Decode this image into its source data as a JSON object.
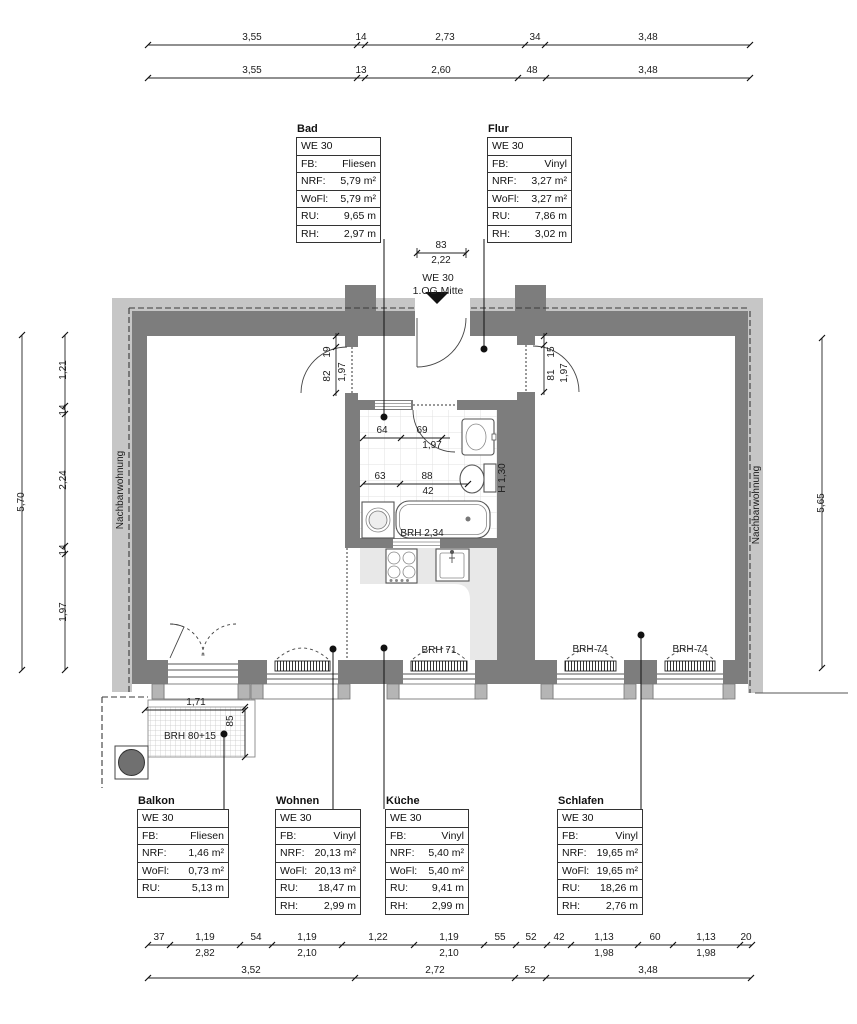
{
  "colors": {
    "wall_dark": "#7d7d7d",
    "wall_light": "#c6c6c6",
    "counter": "#e8e8e8"
  },
  "header_dims": {
    "row1": [
      "3,55",
      "14",
      "2,73",
      "34",
      "3,48"
    ],
    "row2": [
      "3,55",
      "13",
      "2,60",
      "48",
      "3,48"
    ]
  },
  "footer_dims": {
    "row1": [
      "37",
      "1,19",
      "54",
      "1,19",
      "1,22",
      "1,19",
      "55",
      "52",
      "42",
      "1,13",
      "60",
      "1,13",
      "20"
    ],
    "row1_sub": [
      "2,82",
      "2,10",
      "2,10",
      "1,98",
      "1,98"
    ],
    "row2": [
      "3,52",
      "2,72",
      "52",
      "3,48"
    ]
  },
  "side_dims": {
    "left_total": "5,70",
    "left_chain": [
      "1,21",
      "14",
      "2,24",
      "14",
      "1,97"
    ],
    "right_total": "5,65"
  },
  "entrance": {
    "label_line1": "WE 30",
    "label_line2": "1.OG Mitte",
    "width": "83",
    "width_total": "2,22"
  },
  "plan_labels": {
    "neighbor_left": "Nachbarwohnung",
    "neighbor_right": "Nachbarwohnung",
    "door_wohnen": [
      "19",
      "82",
      "1,97"
    ],
    "door_schlafen": [
      "15",
      "81",
      "1,97"
    ],
    "door_bad": [
      "64",
      "69",
      "1,97"
    ],
    "bad_inner": [
      "63",
      "88",
      "42"
    ],
    "bath_height": "H 1,30",
    "brh_tub": "BRH 2,34",
    "brh_kitchen": "BRH 71",
    "brh_bedroom1": "BRH 74",
    "brh_bedroom2": "BRH 74",
    "brh_balcony": "BRH 80+15",
    "balcony_width": "1,71",
    "balcony_depth": "85"
  },
  "room_tables": {
    "bad": {
      "title": "Bad",
      "we": "WE 30",
      "rows": [
        [
          "FB:",
          "Fliesen"
        ],
        [
          "NRF:",
          "5,79 m²"
        ],
        [
          "WoFl:",
          "5,79 m²"
        ],
        [
          "RU:",
          "9,65 m"
        ],
        [
          "RH:",
          "2,97 m"
        ]
      ]
    },
    "flur": {
      "title": "Flur",
      "we": "WE 30",
      "rows": [
        [
          "FB:",
          "Vinyl"
        ],
        [
          "NRF:",
          "3,27 m²"
        ],
        [
          "WoFl:",
          "3,27 m²"
        ],
        [
          "RU:",
          "7,86 m"
        ],
        [
          "RH:",
          "3,02 m"
        ]
      ]
    },
    "balkon": {
      "title": "Balkon",
      "we": "WE 30",
      "rows": [
        [
          "FB:",
          "Fliesen"
        ],
        [
          "NRF:",
          "1,46 m²"
        ],
        [
          "WoFl:",
          "0,73 m²"
        ],
        [
          "RU:",
          "5,13 m"
        ]
      ]
    },
    "wohnen": {
      "title": "Wohnen",
      "we": "WE 30",
      "rows": [
        [
          "FB:",
          "Vinyl"
        ],
        [
          "NRF:",
          "20,13 m²"
        ],
        [
          "WoFl:",
          "20,13 m²"
        ],
        [
          "RU:",
          "18,47 m"
        ],
        [
          "RH:",
          "2,99 m"
        ]
      ]
    },
    "kueche": {
      "title": "Küche",
      "we": "WE 30",
      "rows": [
        [
          "FB:",
          "Vinyl"
        ],
        [
          "NRF:",
          "5,40 m²"
        ],
        [
          "WoFl:",
          "5,40 m²"
        ],
        [
          "RU:",
          "9,41 m"
        ],
        [
          "RH:",
          "2,99 m"
        ]
      ]
    },
    "schlafen": {
      "title": "Schlafen",
      "we": "WE 30",
      "rows": [
        [
          "FB:",
          "Vinyl"
        ],
        [
          "NRF:",
          "19,65 m²"
        ],
        [
          "WoFl:",
          "19,65 m²"
        ],
        [
          "RU:",
          "18,26 m"
        ],
        [
          "RH:",
          "2,76 m"
        ]
      ]
    }
  }
}
